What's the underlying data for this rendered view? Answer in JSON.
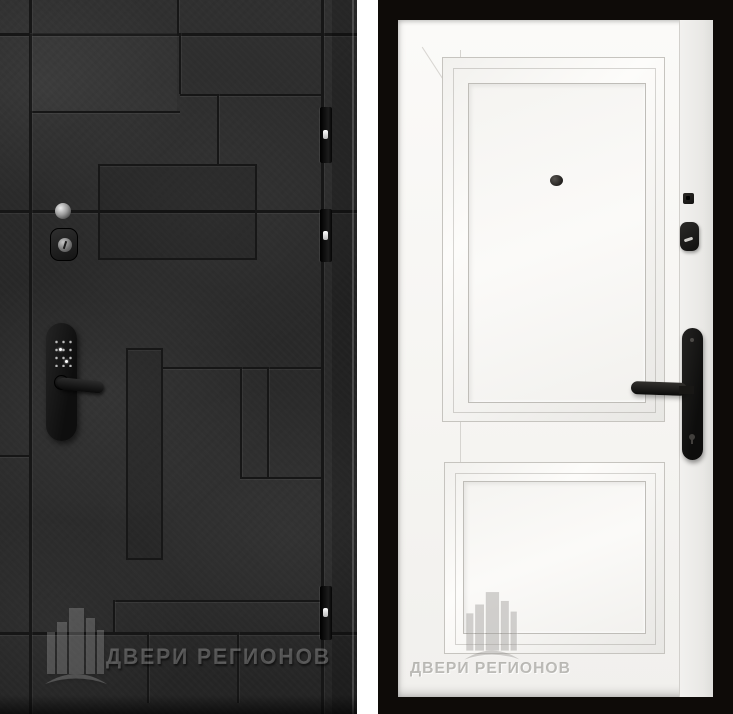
{
  "photo": {
    "background_color": "#ffffff",
    "subject": "two entry door panels, exterior dark side and interior white side"
  },
  "brand": {
    "watermark": "ДВЕРИ РЕГИОНОВ"
  },
  "left_door": {
    "finish_color": "#2b2b2b",
    "groove_color": "#161616",
    "hinges": 3,
    "hardware": {
      "peephole": "peephole",
      "cylinder_lock": "cylinder lock",
      "smart_lock": "smart lock with keypad and lever handle"
    }
  },
  "right_door": {
    "leaf_color": "#f7f6f3",
    "frame_color": "#0e0b08",
    "panels": 2,
    "hardware": {
      "peephole": "peephole",
      "deadbolt_indicator": "deadbolt indicator",
      "cylinder_cover": "cylinder cover",
      "handle": "lever handle on escutcheon plate"
    }
  }
}
